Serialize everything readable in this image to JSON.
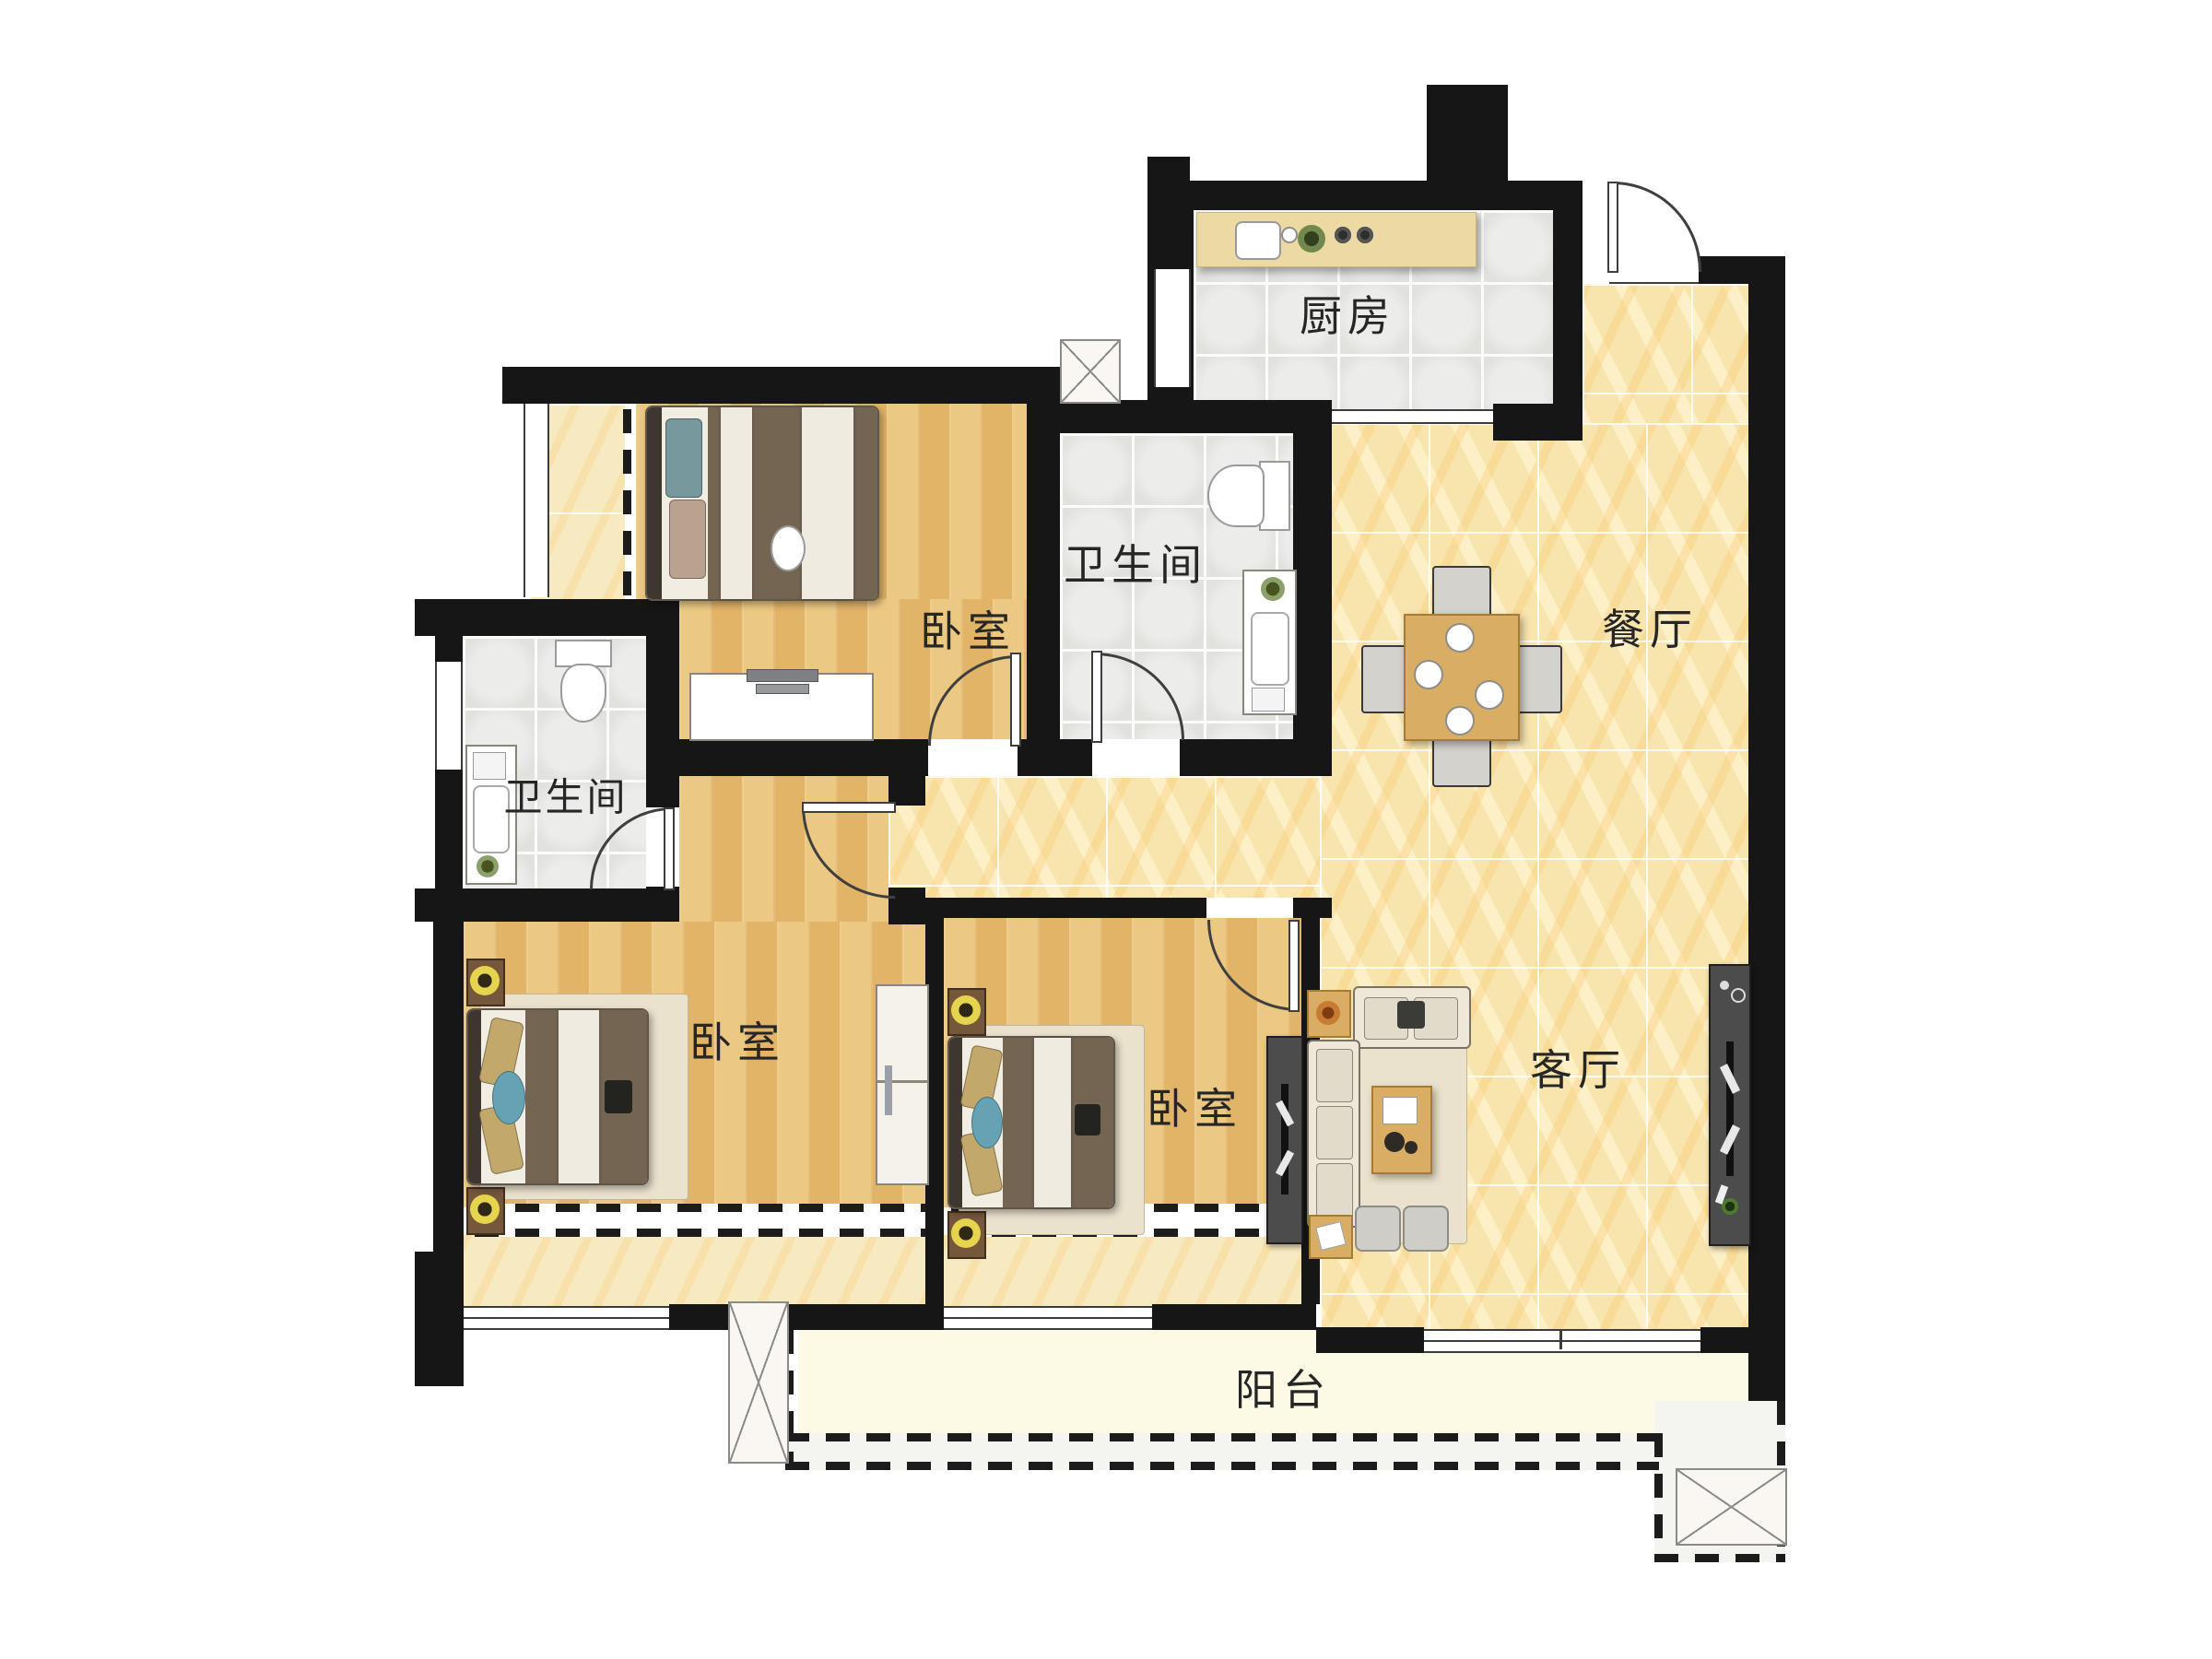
{
  "title": "三室两厅户型平面图",
  "rooms": [
    {
      "id": "kitchen",
      "label": "厨房"
    },
    {
      "id": "dining",
      "label": "餐厅"
    },
    {
      "id": "bedroom-top",
      "label": "卧室"
    },
    {
      "id": "bathroom-top",
      "label": "卫生间"
    },
    {
      "id": "bathroom-left",
      "label": "卫生间"
    },
    {
      "id": "bedroom-left",
      "label": "卧室"
    },
    {
      "id": "bedroom-mid",
      "label": "卧室"
    },
    {
      "id": "living",
      "label": "客厅"
    },
    {
      "id": "balcony",
      "label": "阳台"
    }
  ],
  "colors": {
    "wall": "#161616",
    "wood_floor": "#eac47c",
    "marble_floor": "#f8e5ae",
    "tile_floor": "#eaeae7",
    "balcony_floor": "#fcfae5",
    "label_text": "#262626"
  }
}
